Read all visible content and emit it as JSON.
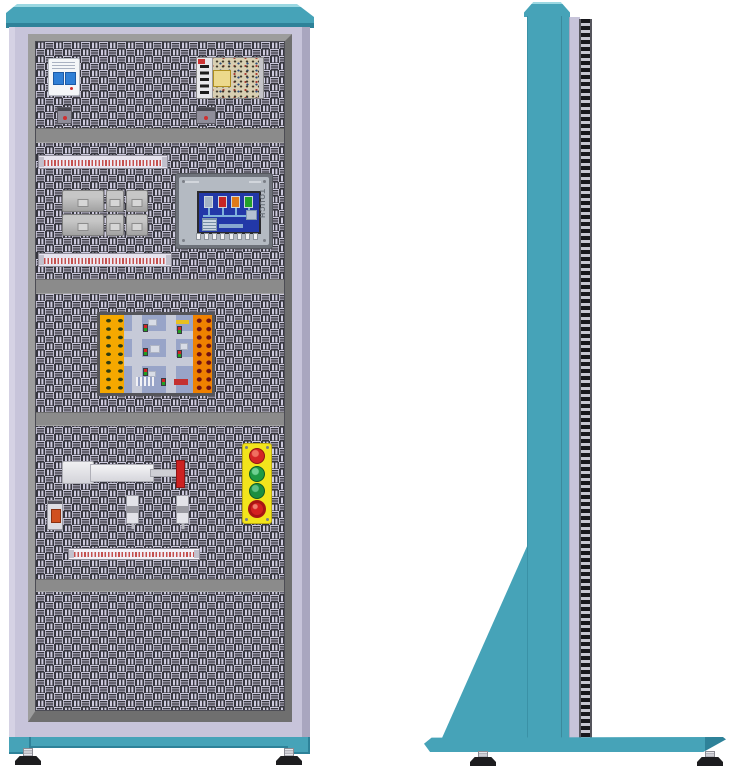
{
  "scene": {
    "description": "Two-view technical illustration of an electrical automation training cabinet",
    "views": [
      {
        "label": "front"
      },
      {
        "label": "side"
      }
    ]
  },
  "front": {
    "sections": [
      {
        "name": "incoming-power",
        "components": [
          "circuit-breaker",
          "switch-mode-power-supply",
          "terminal-block",
          "terminal-block"
        ]
      },
      {
        "name": "control-row",
        "components": [
          "din-terminal-strip",
          "relay-contactor-group",
          "hmi-touch-panel",
          "din-terminal-strip"
        ]
      },
      {
        "name": "plc-training-board",
        "components": [
          "traffic-intersection-board"
        ]
      },
      {
        "name": "actuator-row",
        "components": [
          "pneumatic-cylinder",
          "proximity-sensor",
          "proximity-sensor",
          "indicator-module",
          "push-button-station",
          "din-terminal-strip"
        ]
      },
      {
        "name": "blank-panel",
        "components": []
      }
    ],
    "hmi": {
      "touch_label": "TOUCH",
      "function_key_count": 8,
      "tank_colors": [
        "#a4b4c6",
        "#c62525",
        "#df7a1a",
        "#23a22b"
      ]
    },
    "push_button_station": {
      "body_color": "#f2e41c",
      "buttons": [
        "#d42525",
        "#1f9a44",
        "#1c8f40"
      ],
      "emergency_stop": "#c81f1f"
    },
    "relay_blocks": 6,
    "terminal_strips": 3
  },
  "side": {
    "components": [
      "column",
      "perforated-panel-edge",
      "support-gusset",
      "base-plate",
      "leveling-feet"
    ]
  },
  "colors": {
    "teal": "#46a3b8",
    "teal_dark": "#2e8299",
    "teal_light": "#9bd8e2",
    "lavender": "#c7c4da",
    "lavender_dark": "#a9a6bf",
    "frame_gray": "#8b8b8b",
    "frame_dark": "#6f6f6f",
    "frame_light": "#9d9d9d",
    "weave_light": "#cecbdf",
    "weave_dark": "#36363e",
    "screen_blue": "#2238a8",
    "board_yellow": "#f5a800",
    "board_orange": "#ef8100",
    "terminal_red": "#c4504e",
    "btn_yellow": "#f2e41c"
  }
}
